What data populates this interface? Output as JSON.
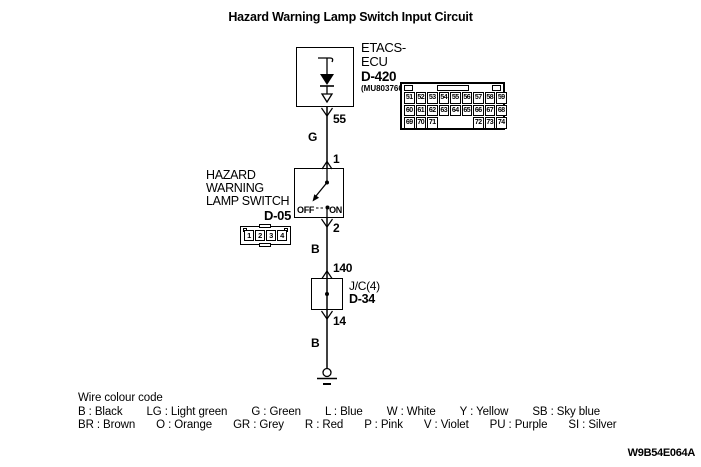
{
  "title": "Hazard Warning Lamp Switch Input Circuit",
  "doc_code": "W9B54E064A",
  "etacs": {
    "name_line1": "ETACS-",
    "name_line2": "ECU",
    "connector_id": "D-420",
    "connector_sub": "(MU803766)"
  },
  "etacs_connector": {
    "rows": [
      [
        "51",
        "52",
        "53",
        "54",
        "55",
        "56",
        "57",
        "58",
        "59"
      ],
      [
        "60",
        "61",
        "62",
        "63",
        "64",
        "65",
        "66",
        "67",
        "68"
      ],
      [
        "69",
        "70",
        "71",
        "",
        "",
        "",
        "72",
        "73",
        "74"
      ]
    ]
  },
  "switch": {
    "label_line1": "HAZARD",
    "label_line2": "WARNING",
    "label_line3": "LAMP SWITCH",
    "connector_id": "D-05",
    "off_label": "OFF",
    "on_label": "ON",
    "pins": [
      "1",
      "2",
      "3",
      "4"
    ]
  },
  "junction": {
    "label": "J/C(4)",
    "connector_id": "D-34"
  },
  "wire_labels": {
    "pin_55": "55",
    "color_g": "G",
    "pin_1": "1",
    "pin_2": "2",
    "color_b_upper": "B",
    "pin_140": "140",
    "pin_14": "14",
    "color_b_lower": "B"
  },
  "legend": {
    "heading": "Wire colour code",
    "separator": " : ",
    "rows": [
      [
        {
          "code": "B",
          "name": "Black"
        },
        {
          "code": "LG",
          "name": "Light green"
        },
        {
          "code": "G",
          "name": "Green"
        },
        {
          "code": "L",
          "name": "Blue"
        },
        {
          "code": "W",
          "name": "White"
        },
        {
          "code": "Y",
          "name": "Yellow"
        },
        {
          "code": "SB",
          "name": "Sky blue"
        }
      ],
      [
        {
          "code": "BR",
          "name": "Brown"
        },
        {
          "code": "O",
          "name": "Orange"
        },
        {
          "code": "GR",
          "name": "Grey"
        },
        {
          "code": "R",
          "name": "Red"
        },
        {
          "code": "P",
          "name": "Pink"
        },
        {
          "code": "V",
          "name": "Violet"
        },
        {
          "code": "PU",
          "name": "Purple"
        },
        {
          "code": "SI",
          "name": "Silver"
        }
      ]
    ]
  }
}
